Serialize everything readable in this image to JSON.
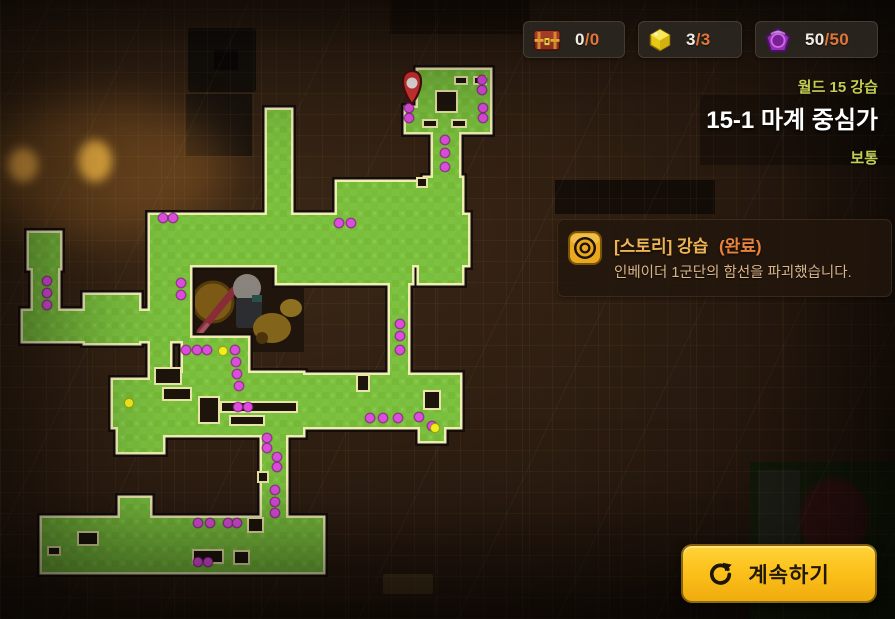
{
  "colors": {
    "accent_yellow": "#fcc11c",
    "number_white": "#f2ede4",
    "number_orange": "#e0763a",
    "world_text": "#c3cf52",
    "title_text": "#ffffff",
    "quest_gold": "#eeb453",
    "quest_orange": "#e8823c",
    "quest_desc": "#d9b58a",
    "map_green": "#7cc13f",
    "map_green_dark": "#74b838",
    "map_outline": "#f1eeb4",
    "map_edge_dark": "#12100a",
    "hole_fill": "#1d150c",
    "dot_magenta": "#dd4ddd",
    "dot_yellow": "#f0ee1e",
    "pin_red": "#d63434"
  },
  "hud": {
    "counters": [
      {
        "icon": "chest-icon",
        "current": "0",
        "sep": "/",
        "max": "0"
      },
      {
        "icon": "gem-yellow-icon",
        "current": "3",
        "sep": "/",
        "max": "3"
      },
      {
        "icon": "gem-purple-icon",
        "current": "50",
        "sep": "/",
        "max": "50"
      }
    ]
  },
  "stage": {
    "world_label": "월드 15 강습",
    "title": "15-1 마계 중심가",
    "difficulty": "보통"
  },
  "quest": {
    "icon": "target-rings-icon",
    "category": "[스토리] 강습",
    "status": "(완료)",
    "description": "인베이더 1군단의 함선을 파괴했습니다."
  },
  "actions": {
    "continue_label": "계속하기"
  },
  "map": {
    "pin": {
      "x": 412,
      "y": 84
    },
    "rooms": [
      [
        418,
        70,
        72,
        40
      ],
      [
        406,
        108,
        84,
        24
      ],
      [
        433,
        132,
        26,
        48
      ],
      [
        425,
        178,
        37,
        40
      ],
      [
        337,
        182,
        125,
        33
      ],
      [
        267,
        110,
        24,
        108
      ],
      [
        150,
        215,
        318,
        50
      ],
      [
        29,
        233,
        31,
        35
      ],
      [
        33,
        268,
        25,
        48
      ],
      [
        23,
        311,
        167,
        30
      ],
      [
        85,
        295,
        54,
        48
      ],
      [
        150,
        263,
        40,
        72
      ],
      [
        277,
        261,
        135,
        22
      ],
      [
        419,
        265,
        43,
        18
      ],
      [
        390,
        283,
        18,
        95
      ],
      [
        150,
        330,
        20,
        47
      ],
      [
        183,
        338,
        65,
        37
      ],
      [
        150,
        373,
        153,
        62
      ],
      [
        303,
        375,
        157,
        52
      ],
      [
        420,
        427,
        24,
        14
      ],
      [
        262,
        427,
        24,
        93
      ],
      [
        113,
        380,
        69,
        47
      ],
      [
        118,
        427,
        45,
        25
      ],
      [
        120,
        498,
        30,
        22
      ],
      [
        42,
        518,
        281,
        54
      ]
    ],
    "holes": [
      [
        436,
        91,
        21,
        21
      ],
      [
        455,
        77,
        12,
        7
      ],
      [
        474,
        77,
        12,
        7
      ],
      [
        423,
        120,
        14,
        7
      ],
      [
        452,
        120,
        14,
        7
      ],
      [
        417,
        178,
        10,
        9
      ],
      [
        163,
        388,
        28,
        12
      ],
      [
        199,
        397,
        20,
        26
      ],
      [
        221,
        402,
        76,
        10
      ],
      [
        230,
        416,
        34,
        9
      ],
      [
        155,
        368,
        26,
        16
      ],
      [
        357,
        375,
        12,
        16
      ],
      [
        424,
        391,
        16,
        18
      ],
      [
        258,
        472,
        10,
        10
      ],
      [
        78,
        532,
        20,
        13
      ],
      [
        48,
        547,
        12,
        8
      ],
      [
        193,
        550,
        30,
        13
      ],
      [
        248,
        518,
        15,
        14
      ],
      [
        234,
        551,
        15,
        13
      ]
    ],
    "dots_magenta": [
      [
        409,
        108
      ],
      [
        409,
        118
      ],
      [
        482,
        80
      ],
      [
        482,
        90
      ],
      [
        483,
        108
      ],
      [
        483,
        118
      ],
      [
        445,
        140
      ],
      [
        445,
        153
      ],
      [
        445,
        167
      ],
      [
        163,
        218
      ],
      [
        173,
        218
      ],
      [
        339,
        223
      ],
      [
        351,
        223
      ],
      [
        47,
        281
      ],
      [
        47,
        293
      ],
      [
        47,
        305
      ],
      [
        181,
        283
      ],
      [
        181,
        295
      ],
      [
        186,
        350
      ],
      [
        197,
        350
      ],
      [
        207,
        350
      ],
      [
        235,
        350
      ],
      [
        236,
        362
      ],
      [
        237,
        374
      ],
      [
        239,
        386
      ],
      [
        400,
        324
      ],
      [
        400,
        336
      ],
      [
        400,
        350
      ],
      [
        238,
        407
      ],
      [
        248,
        407
      ],
      [
        370,
        418
      ],
      [
        383,
        418
      ],
      [
        398,
        418
      ],
      [
        419,
        417
      ],
      [
        432,
        426
      ],
      [
        267,
        438
      ],
      [
        267,
        448
      ],
      [
        277,
        457
      ],
      [
        277,
        467
      ],
      [
        275,
        490
      ],
      [
        275,
        502
      ],
      [
        275,
        513
      ],
      [
        198,
        523
      ],
      [
        210,
        523
      ],
      [
        228,
        523
      ],
      [
        237,
        523
      ],
      [
        198,
        562
      ],
      [
        208,
        562
      ]
    ],
    "dots_yellow": [
      [
        223,
        351
      ],
      [
        129,
        403
      ],
      [
        435,
        428
      ]
    ]
  }
}
